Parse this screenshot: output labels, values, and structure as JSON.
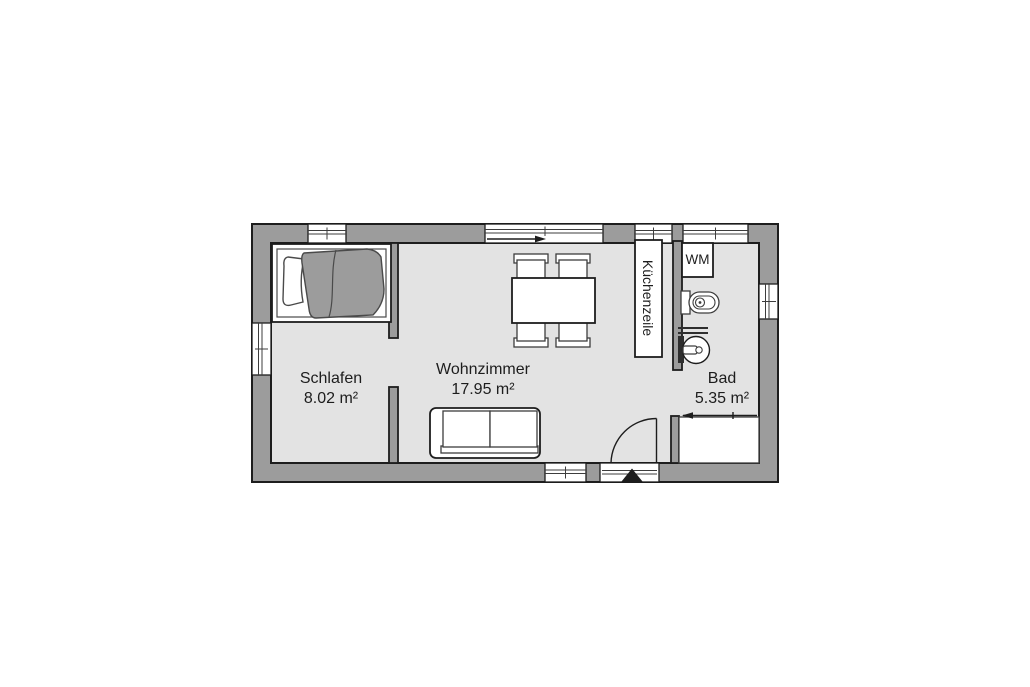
{
  "plan": {
    "rooms": [
      {
        "id": "schlafen",
        "name": "Schlafen",
        "area": "8.02 m²"
      },
      {
        "id": "wohnzimmer",
        "name": "Wohnzimmer",
        "area": "17.95 m²"
      },
      {
        "id": "bad",
        "name": "Bad",
        "area": "5.35 m²"
      }
    ],
    "fixtures": {
      "kitchen_unit": "Küchenzeile",
      "washing_machine": "WM"
    },
    "colors": {
      "wall": "#9c9c9c",
      "floor": "#e3e3e3",
      "outline": "#1d1d1d",
      "background": "#ffffff",
      "blanket": "#9c9c9c"
    }
  }
}
